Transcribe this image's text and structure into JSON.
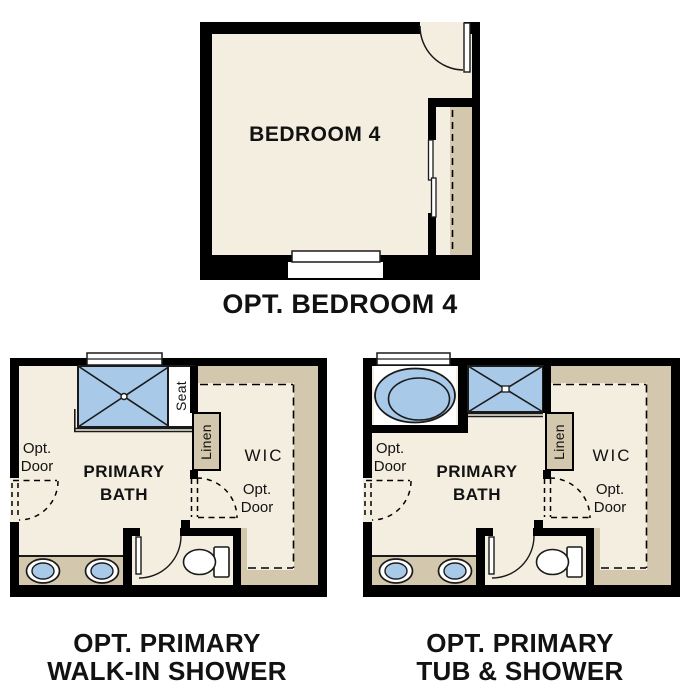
{
  "colors": {
    "wall": "#000000",
    "floor": "#f3eee0",
    "tan": "#d3c7ad",
    "fixture_blue": "#a9c9e8",
    "background": "#ffffff",
    "text": "#121212"
  },
  "plans": {
    "bedroom": {
      "room_label": "BEDROOM 4",
      "title": "OPT. BEDROOM 4"
    },
    "walk_in_shower": {
      "title_line1": "OPT. PRIMARY",
      "title_line2": "WALK-IN SHOWER",
      "room_line1": "PRIMARY",
      "room_line2": "BATH",
      "wic_label": "WIC",
      "linen_label": "Linen",
      "seat_label": "Seat",
      "opt_door_left_line1": "Opt.",
      "opt_door_left_line2": "Door",
      "opt_door_wic_line1": "Opt.",
      "opt_door_wic_line2": "Door"
    },
    "tub_and_shower": {
      "title_line1": "OPT. PRIMARY",
      "title_line2": "TUB & SHOWER",
      "room_line1": "PRIMARY",
      "room_line2": "BATH",
      "wic_label": "WIC",
      "linen_label": "Linen",
      "opt_door_left_line1": "Opt.",
      "opt_door_left_line2": "Door",
      "opt_door_wic_line1": "Opt.",
      "opt_door_wic_line2": "Door"
    }
  }
}
